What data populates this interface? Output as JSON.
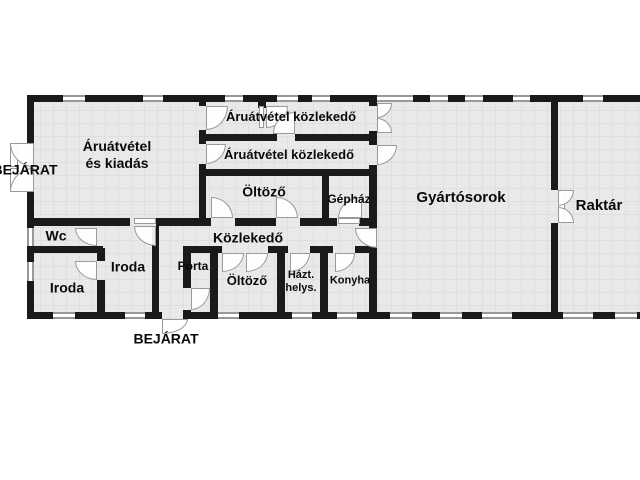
{
  "title": "Floor plan",
  "rooms": {
    "aruatvetel": "Áruátvétel\nés kiadás",
    "corr1": "Áruátvétel közlekedő",
    "corr2": "Áruátvétel közlekedő",
    "oltozo1": "Öltöző",
    "gephaz": "Gépház",
    "gyartosorok": "Gyártósorok",
    "raktar": "Raktár",
    "wc": "Wc",
    "iroda1": "Iroda",
    "iroda2": "Iroda",
    "porta": "Porta",
    "kozlekedo": "Közlekedő",
    "oltozo2": "Öltöző",
    "hazt": "Házt.\nhelys.",
    "konyha": "Konyha"
  },
  "entrances": {
    "left": "BEJÁRAT",
    "bottom": "BEJÁRAT"
  },
  "colors": {
    "wall": "#1a1a1a",
    "floor": "#e9e9e9",
    "floor_grid": "#dfdfdf",
    "window_frame": "#999999",
    "door_arc": "#999999",
    "text": "#0a0a0a",
    "background": "#ffffff"
  }
}
